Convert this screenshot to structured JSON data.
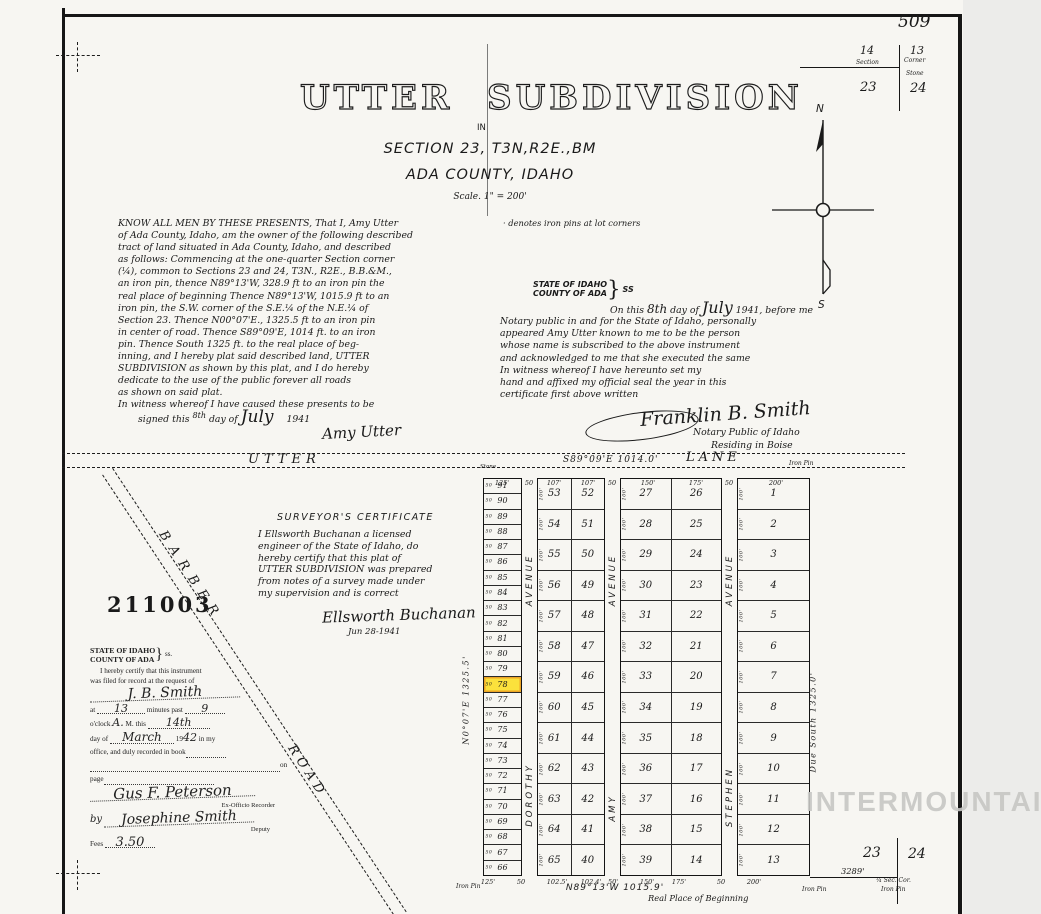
{
  "page": {
    "number": "509",
    "watermark": "INTERMOUNTAIN"
  },
  "corner_top": {
    "nw": "14",
    "ne": "13",
    "sw": "23",
    "se": "24",
    "l1": "Section",
    "l2": "Corner",
    "l3": "Stone"
  },
  "corner_bottom": {
    "w": "23",
    "e": "24",
    "distance": "3289'",
    "cor": "¼ Sec. Cor.",
    "pin": "Iron Pin",
    "pin_left": "Iron Pin"
  },
  "title": {
    "main": "UTTER  SUBDIVISION",
    "in_word": "IN",
    "section_line": "SECTION 23, T3N,R2E.,BM",
    "county_line": "ADA COUNTY, IDAHO",
    "scale": "Scale. 1\" = 200'"
  },
  "note": "· denotes iron pins at lot corners",
  "compass": {
    "n": "N",
    "s": "S"
  },
  "dedication": {
    "lines": [
      "KNOW ALL MEN BY THESE PRESENTS, That I, Amy Utter",
      "of Ada County, Idaho, am the owner of the following described",
      "tract of land situated in Ada County, Idaho, and described",
      "as follows:     Commencing at the one-quarter Section corner",
      "(¼), common to Sections 23 and 24, T3N., R2E., B.B.&M.,",
      "an iron pin, thence N89°13'W, 328.9 ft to an iron pin the",
      "real place of beginning Thence N89°13'W, 1015.9 ft to an",
      "iron pin, the S.W. corner of the S.E.¼ of the N.E.¼ of",
      "Section 23. Thence N00°07'E., 1325.5 ft to an iron pin",
      "in center of road. Thence S89°09'E, 1014 ft. to an iron",
      "pin. Thence South 1325 ft. to the real place of beg-",
      "inning, and I hereby plat said described land, UTTER",
      "SUBDIVISION as shown by this plat, and I do hereby",
      "dedicate to the use of the public forever all roads",
      "as shown on said plat.",
      "In witness whereof I have caused these presents to be"
    ],
    "signed": {
      "pre": "signed this",
      "day": "8th",
      "mid": "day of",
      "month": "July",
      "year": "1941"
    },
    "signature": "Amy Utter"
  },
  "notary": {
    "state": "STATE OF IDAHO",
    "county": "COUNTY OF ADA",
    "brace": "}",
    "ss": "SS",
    "first": {
      "pre": "On this",
      "day": "8th",
      "mid": "day of",
      "month": "July",
      "post": "1941, before me"
    },
    "lines": [
      "Notary public in and for the State of Idaho, personally",
      "appeared Amy Utter known to me to be the person",
      "whose name is subscribed to the above instrument",
      "and acknowledged to me that she executed the same",
      "In witness whereof I have hereunto set my",
      "hand and affixed my official seal the year in this",
      "certificate first above written"
    ],
    "signature": "Franklin B. Smith",
    "title1": "Notary Public of Idaho",
    "title2": "Residing in Boise"
  },
  "surveyor": {
    "heading": "SURVEYOR'S CERTIFICATE",
    "lines": [
      "I Ellsworth Buchanan a licensed",
      "engineer of the State of Idaho, do",
      "hereby certify that this plat of",
      "UTTER SUBDIVISION was prepared",
      "from notes of a survey made under",
      "my supervision and is correct"
    ],
    "signature": "Ellsworth Buchanan",
    "date": "Jun 28-1941"
  },
  "recorder": {
    "state": "STATE OF IDAHO",
    "county": "COUNTY OF ADA",
    "brace": "}",
    "ss": "ss.",
    "cert1": "I hereby certify that this instrument",
    "cert2": "was filed for record at the request of",
    "requester": "J. B. Smith",
    "at_label": "at",
    "minutes": "13",
    "minutes_label": "minutes past",
    "hour": "9",
    "oclock_label": "o'clock",
    "am": "A.",
    "m_this": "M. this",
    "day": "14th",
    "day_of": "day of",
    "month": "March",
    "year_pre": "19",
    "year": "42",
    "in_my": "in my",
    "book_line": "office, and duly recorded in book",
    "on_label": "on",
    "page_label": "page",
    "recorder_sig": "Gus F. Peterson",
    "recorder_title": "Ex-Officio Recorder",
    "by": "by",
    "deputy_sig": "Josephine Smith",
    "deputy_title": "Deputy",
    "fees_label": "Fees",
    "fees_value": "3.50"
  },
  "stamp": "211003",
  "barber": {
    "name": "BARBER",
    "road": "ROAD"
  },
  "lane": {
    "utter": "UTTER",
    "bearing": "S89°09'E  1014.0'",
    "lane": "LANE",
    "stone": "Stone",
    "iron_pin": "Iron Pin"
  },
  "plat": {
    "left_bearing": "N0°07'E   1325.5'",
    "right_bearing": "Due South   1325.0'",
    "bottom_bearing": "N89°13'W    1015.9'",
    "real_place": "Real Place of Beginning",
    "iron_pin_sw": "Iron Pin",
    "top_dims": [
      "125'",
      "50",
      "107'",
      "107'",
      "50",
      "150'",
      "175'",
      "50",
      "200'"
    ],
    "bottom_dims": [
      "125'",
      "50",
      "102.5'",
      "102.4'",
      "50'",
      "150'",
      "175'",
      "50",
      "200'"
    ],
    "depth_50": "50",
    "depth_100": "100'",
    "avenues": [
      {
        "name": "DOROTHY",
        "suffix": "AVENUE"
      },
      {
        "name": "AMY",
        "suffix": "AVENUE"
      },
      {
        "name": "STEPHEN",
        "suffix": "AVENUE"
      }
    ],
    "col_a": [
      91,
      90,
      89,
      88,
      87,
      86,
      85,
      84,
      83,
      82,
      81,
      80,
      79,
      78,
      77,
      76,
      75,
      74,
      73,
      72,
      71,
      70,
      69,
      68,
      67,
      66
    ],
    "block_b_left": [
      53,
      54,
      55,
      56,
      57,
      58,
      59,
      60,
      61,
      62,
      63,
      64,
      65
    ],
    "block_b_right": [
      52,
      51,
      50,
      49,
      48,
      47,
      46,
      45,
      44,
      43,
      42,
      41,
      40
    ],
    "block_c_left": [
      27,
      28,
      29,
      30,
      31,
      32,
      33,
      34,
      35,
      36,
      37,
      38,
      39
    ],
    "block_c_right": [
      26,
      25,
      24,
      23,
      22,
      21,
      20,
      19,
      18,
      17,
      16,
      15,
      14
    ],
    "block_d": [
      1,
      2,
      3,
      4,
      5,
      6,
      7,
      8,
      9,
      10,
      11,
      12,
      13
    ],
    "highlighted_lot": 78
  }
}
